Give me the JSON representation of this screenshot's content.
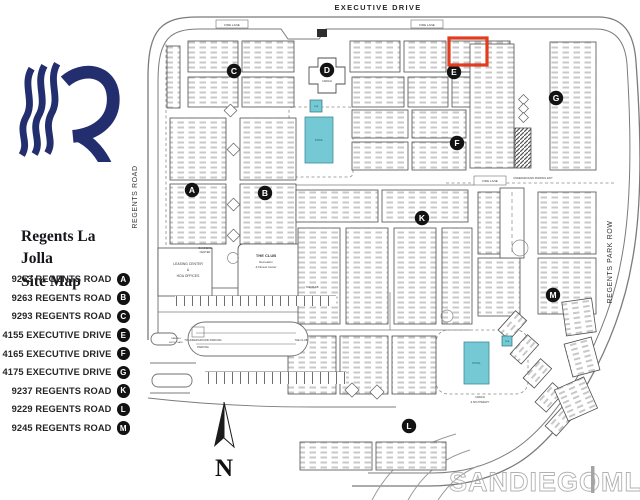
{
  "sidebar": {
    "title_line1": "Regents La Jolla",
    "title_line2": "Site Map",
    "legend": [
      {
        "address": "9253 REGENTS ROAD",
        "letter": "A"
      },
      {
        "address": "9263 REGENTS ROAD",
        "letter": "B"
      },
      {
        "address": "9293 REGENTS ROAD",
        "letter": "C"
      },
      {
        "address": "4155 EXECUTIVE DRIVE",
        "letter": "E"
      },
      {
        "address": "4165 EXECUTIVE DRIVE",
        "letter": "F"
      },
      {
        "address": "4175 EXECUTIVE DRIVE",
        "letter": "G"
      },
      {
        "address": "9237 REGENTS ROAD",
        "letter": "K"
      },
      {
        "address": "9229 REGENTS ROAD",
        "letter": "L"
      },
      {
        "address": "9245 REGENTS ROAD",
        "letter": "M"
      }
    ]
  },
  "map": {
    "streets": {
      "top": "EXECUTIVE DRIVE",
      "left": "REGENTS ROAD",
      "right": "REGENTS PARK ROW"
    },
    "markers": [
      {
        "letter": "A",
        "x": 192,
        "y": 190
      },
      {
        "letter": "B",
        "x": 265,
        "y": 193
      },
      {
        "letter": "C",
        "x": 234,
        "y": 71
      },
      {
        "letter": "D",
        "x": 327,
        "y": 70
      },
      {
        "letter": "E",
        "x": 454,
        "y": 72
      },
      {
        "letter": "F",
        "x": 457,
        "y": 143
      },
      {
        "letter": "G",
        "x": 556,
        "y": 98
      },
      {
        "letter": "K",
        "x": 422,
        "y": 218
      },
      {
        "letter": "L",
        "x": 409,
        "y": 426
      },
      {
        "letter": "M",
        "x": 553,
        "y": 295
      }
    ],
    "labels": [
      {
        "text": "FIRE LANE",
        "x": 232,
        "y": 26,
        "fs": 3
      },
      {
        "text": "FIRE LANE",
        "x": 427,
        "y": 26,
        "fs": 3
      },
      {
        "text": "FIRE LANE",
        "x": 490,
        "y": 182,
        "fs": 3
      },
      {
        "text": "UNDERGROUND PARKING EXIT",
        "x": 533,
        "y": 179,
        "fs": 2.6
      },
      {
        "text": "TO UNDERGROUND PARKING",
        "x": 203,
        "y": 341,
        "fs": 2.6
      },
      {
        "text": "PARKING",
        "x": 203,
        "y": 348,
        "fs": 2.6
      },
      {
        "text": "PARKING",
        "x": 176,
        "y": 339,
        "fs": 2.2
      },
      {
        "text": "ENTRY GATE",
        "x": 176,
        "y": 343,
        "fs": 2.2
      },
      {
        "text": "CABANA",
        "x": 327,
        "y": 82,
        "fs": 2.4
      },
      {
        "text": "BUSINESS",
        "x": 205,
        "y": 249,
        "fs": 2.6
      },
      {
        "text": "CENTER",
        "x": 205,
        "y": 253,
        "fs": 2.6
      },
      {
        "text": "LEASING CENTER",
        "x": 188,
        "y": 265,
        "fs": 3.4
      },
      {
        "text": "&",
        "x": 188,
        "y": 271,
        "fs": 3.4
      },
      {
        "text": "HOA OFFICES",
        "x": 188,
        "y": 277,
        "fs": 3.4
      },
      {
        "text": "THE CLUB",
        "x": 266,
        "y": 257,
        "fs": 4,
        "bold": true
      },
      {
        "text": "Recreation",
        "x": 266,
        "y": 263,
        "fs": 2.8
      },
      {
        "text": "& Fitness Center",
        "x": 266,
        "y": 268,
        "fs": 2.8
      },
      {
        "text": "THE CLUB",
        "x": 312,
        "y": 288,
        "fs": 2.6
      },
      {
        "text": "THE CLUB",
        "x": 301,
        "y": 341,
        "fs": 2.6
      },
      {
        "text": "CABANA",
        "x": 480,
        "y": 398,
        "fs": 2.4
      },
      {
        "text": "& SPA THERAPY",
        "x": 480,
        "y": 403,
        "fs": 2.4
      }
    ],
    "pools": [
      {
        "label": "POOL",
        "x": 305,
        "y": 117,
        "width": 28,
        "height": 46
      },
      {
        "label": "POOL",
        "x": 464,
        "y": 342,
        "width": 25,
        "height": 42
      }
    ],
    "spas": [
      {
        "label": "SPA",
        "x": 310,
        "y": 100,
        "width": 12,
        "height": 12
      },
      {
        "label": "SPA",
        "x": 502,
        "y": 336,
        "width": 10,
        "height": 10
      }
    ],
    "highlight": {
      "x": 449,
      "y": 38,
      "width": 38,
      "height": 27
    },
    "compass": {
      "label": "N"
    },
    "watermark": {
      "part1": "SANDIEGO",
      "part2": "MLS"
    }
  },
  "colors": {
    "logo_navy": "#232e6f",
    "pool_teal": "#74c9d4",
    "pool_edge": "#3d8d99",
    "highlight_red": "#e23b1e",
    "marker_black": "#131313",
    "map_line": "#4f4f4f",
    "watermark_gray": "#a9a9a9"
  }
}
